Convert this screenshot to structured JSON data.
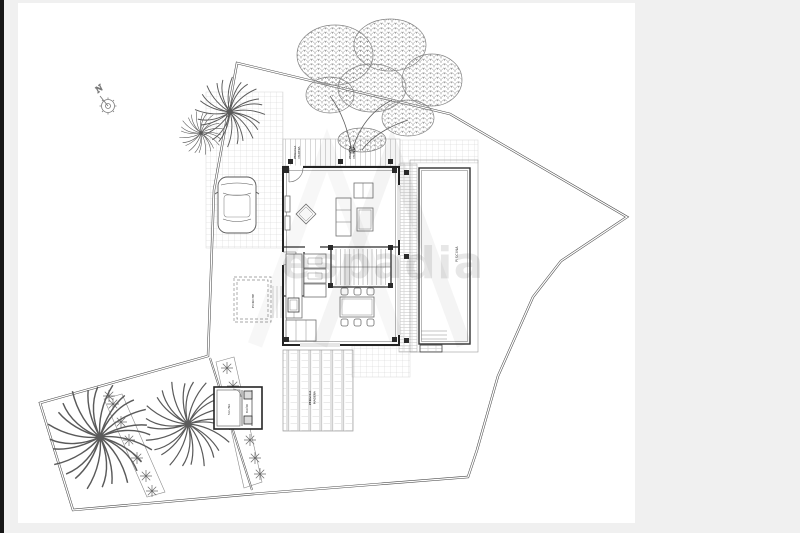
{
  "watermark": {
    "text": "espadia",
    "color": "rgba(70,70,70,0.13)"
  },
  "compass": {
    "label": "N"
  },
  "labels": {
    "pool": "PISCINA",
    "pergola_l1": "PERGOLA",
    "pergola_l2": "MADERA",
    "deck_left_l1": "PERGOLA",
    "deck_left_l2": "MADERA",
    "deck_right_l1": "PERGOLA",
    "deck_right_l2": "MADERA",
    "porch": "PORCHE",
    "annex_room": "SAUNA",
    "annex_bath": "BAÑO"
  },
  "colors": {
    "frame_bar": "#161616",
    "page_margin": "#f0f0f0",
    "paper": "#ffffff",
    "boundary_line": "#4a4a4a",
    "wall_line": "#242424",
    "detail_line": "#777777",
    "hatch_line": "#c8c8c8"
  }
}
